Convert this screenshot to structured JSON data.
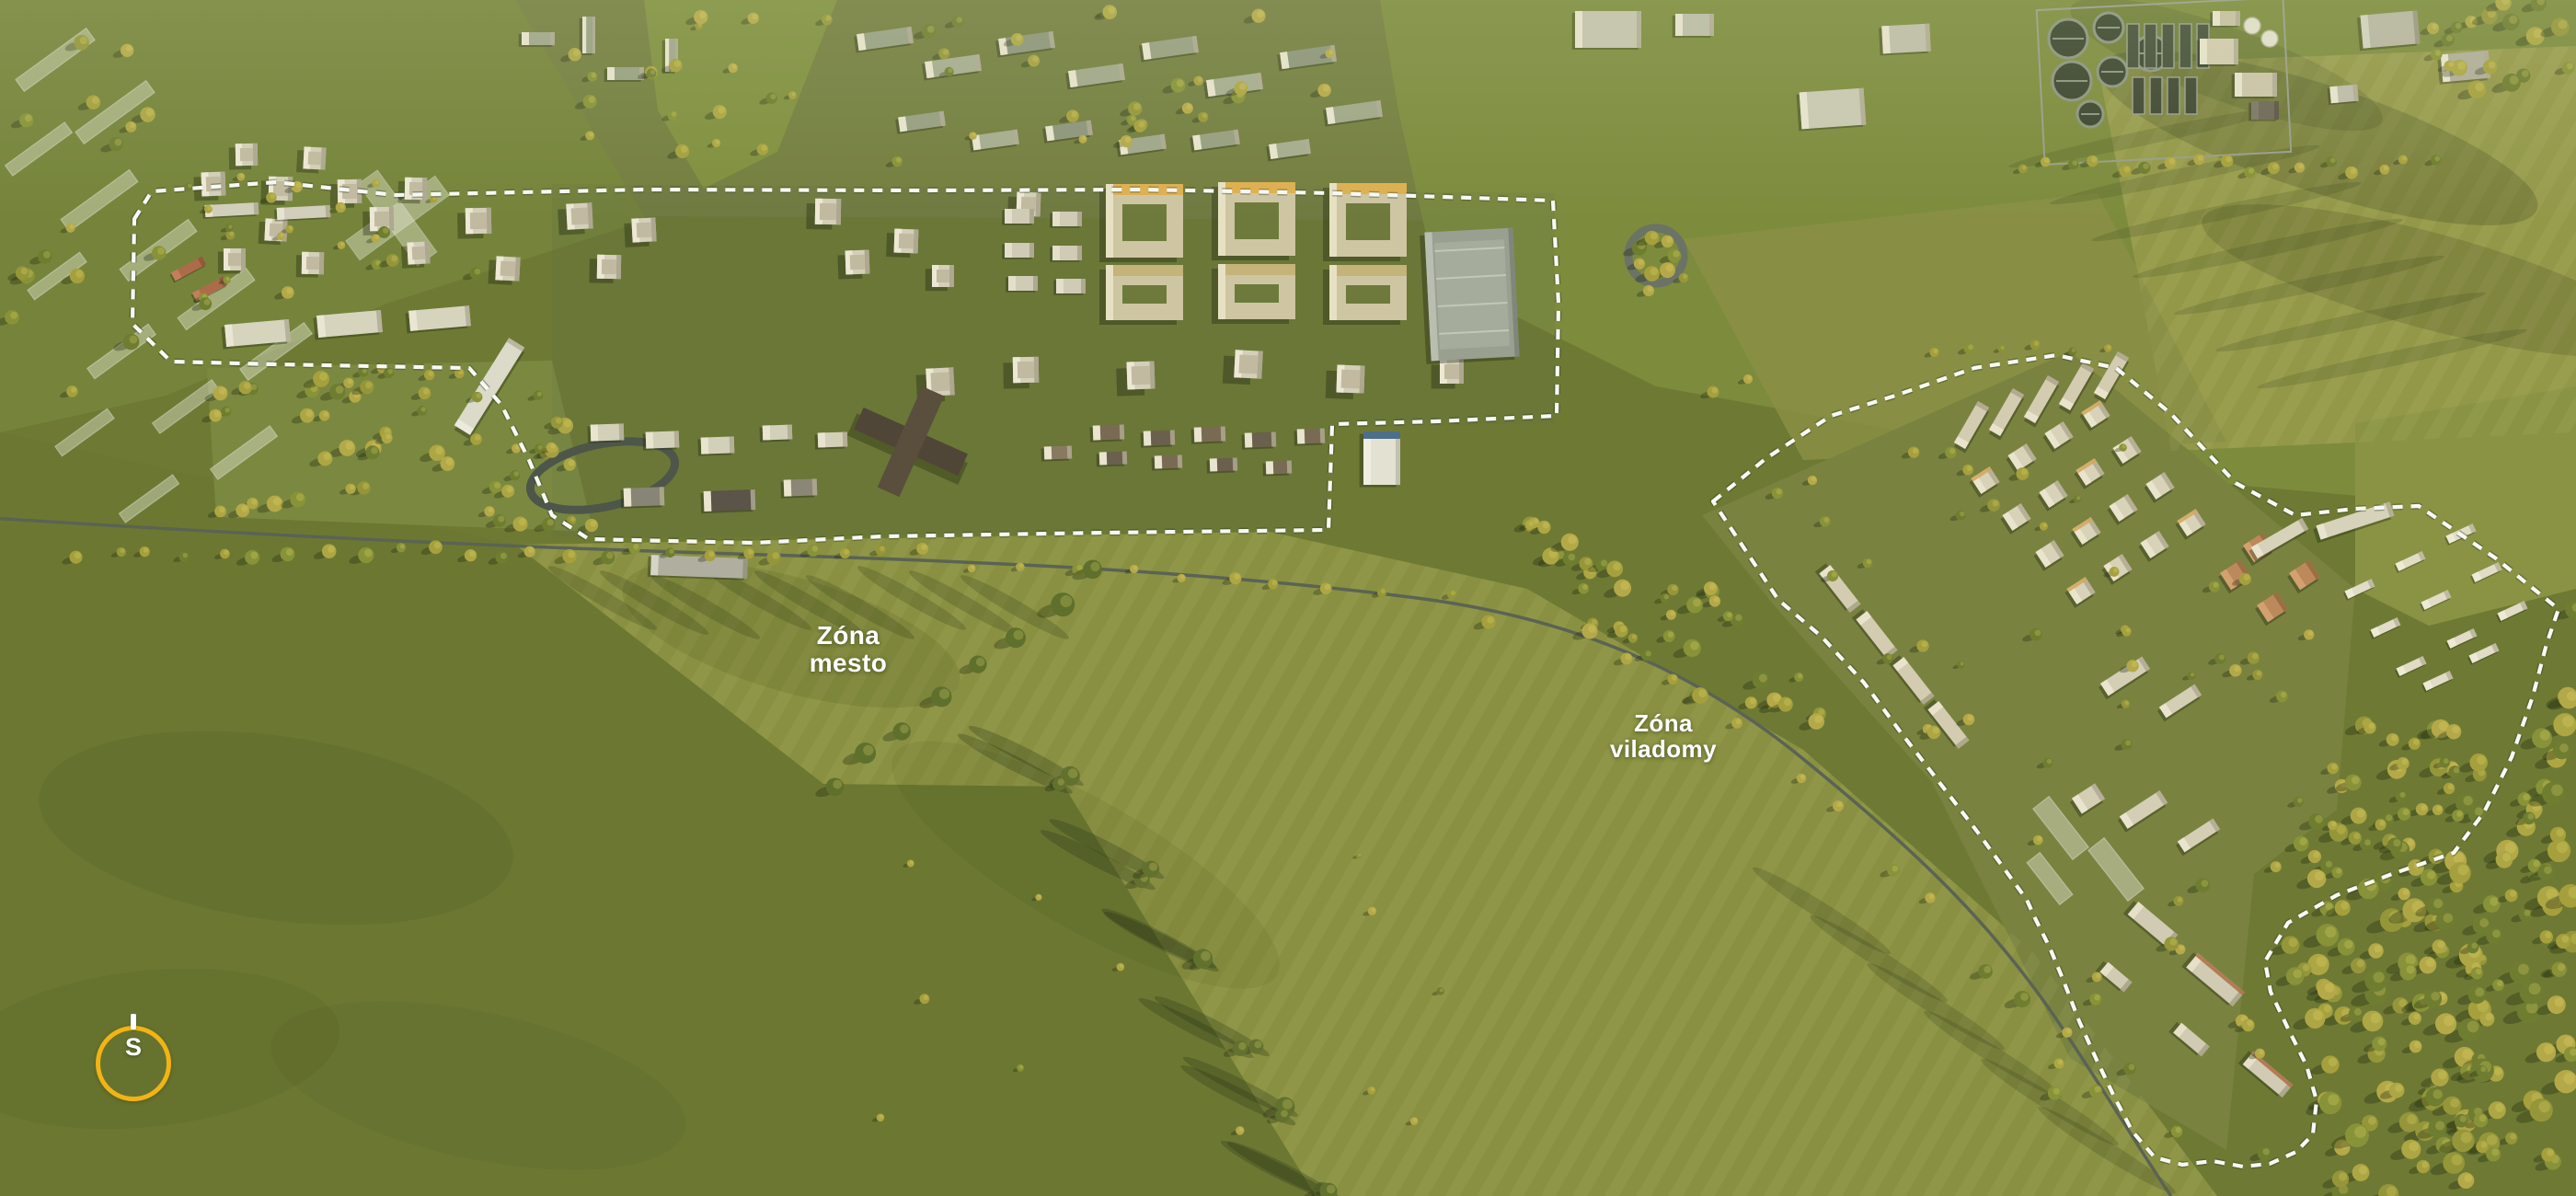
{
  "annotations": {
    "zona_mesto": {
      "line1": "Zóna",
      "line2": "mesto"
    },
    "zona_viladomy": {
      "line1": "Zóna",
      "line2": "viladomy"
    }
  },
  "compass": {
    "north_label": "S"
  },
  "colors": {
    "zone_outline_white": "#ffffff",
    "annotation_text": "#ffffff",
    "compass_ring_yellow": "#f2b414",
    "bike_path_red": "#c4503c"
  }
}
